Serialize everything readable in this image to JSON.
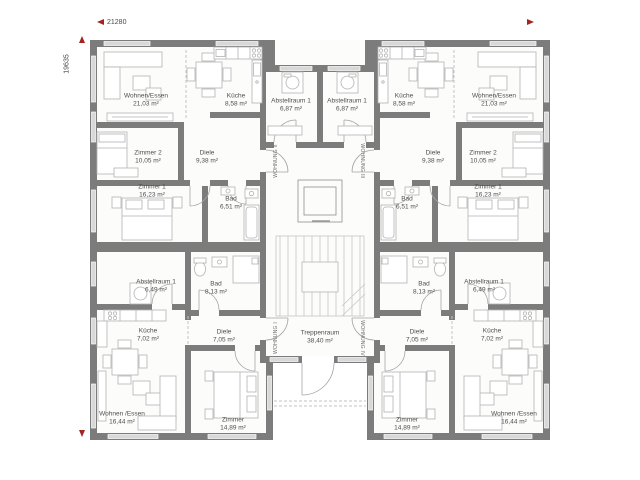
{
  "dimensions": {
    "width_mm": "21280",
    "height_mm": "19635"
  },
  "units": [
    {
      "label": "WOHNUNG I"
    },
    {
      "label": "WOHNUNG II"
    },
    {
      "label": "WOHNUNG III"
    },
    {
      "label": "WOHNUNG IV"
    }
  ],
  "rooms": [
    {
      "name": "Wohnen/Essen",
      "area": "21,03 m²"
    },
    {
      "name": "Küche",
      "area": "8,58 m²"
    },
    {
      "name": "Abstellraum 1",
      "area": "6,87 m²"
    },
    {
      "name": "Abstellraum 1",
      "area": "6,87 m²"
    },
    {
      "name": "Küche",
      "area": "8,58 m²"
    },
    {
      "name": "Wohnen/Essen",
      "area": "21,03 m²"
    },
    {
      "name": "Zimmer 2",
      "area": "10,05 m²"
    },
    {
      "name": "Diele",
      "area": "9,38 m²"
    },
    {
      "name": "Diele",
      "area": "9,38 m²"
    },
    {
      "name": "Zimmer 2",
      "area": "10,05 m²"
    },
    {
      "name": "Zimmer 1",
      "area": "16,23 m²"
    },
    {
      "name": "Bad",
      "area": "6,51 m²"
    },
    {
      "name": "Bad",
      "area": "6,51 m²"
    },
    {
      "name": "Zimmer 1",
      "area": "16,23 m²"
    },
    {
      "name": "Abstellraum 1",
      "area": "6,49 m²"
    },
    {
      "name": "Bad",
      "area": "8,13 m²"
    },
    {
      "name": "Bad",
      "area": "8,13 m²"
    },
    {
      "name": "Abstellraum 1",
      "area": "6,49 m²"
    },
    {
      "name": "Küche",
      "area": "7,02 m²"
    },
    {
      "name": "Diele",
      "area": "7,05 m²"
    },
    {
      "name": "Treppenraum",
      "area": "38,40 m²"
    },
    {
      "name": "Diele",
      "area": "7,05 m²"
    },
    {
      "name": "Küche",
      "area": "7,02 m²"
    },
    {
      "name": "Wohnen /Essen",
      "area": "16,44 m²"
    },
    {
      "name": "Zimmer",
      "area": "14,89 m²"
    },
    {
      "name": "Zimmer",
      "area": "14,89 m²"
    },
    {
      "name": "Wohnen /Essen",
      "area": "16,44 m²"
    }
  ],
  "colors": {
    "wall": "#7c7c7c",
    "window": "#d8d8d8",
    "floor": "#fcfcfb",
    "accent_red": "#a32420",
    "label_text": "#4e4e4e",
    "furniture_line": "#b3b3b3"
  }
}
